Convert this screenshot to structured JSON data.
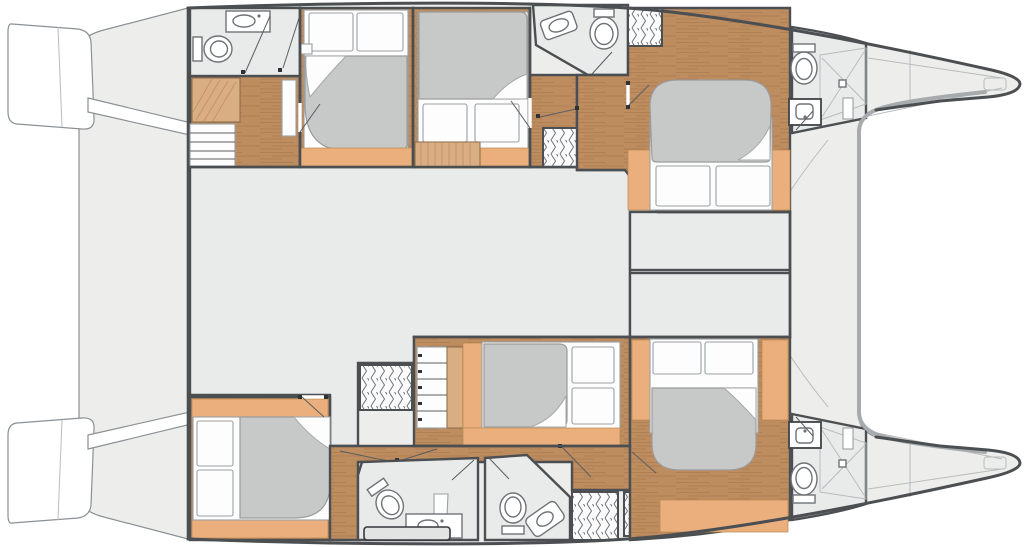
{
  "meta": {
    "type": "floor-plan",
    "subject": "catamaran-yacht-accommodation-deck",
    "orientation": "bow-right",
    "visible_text": "none"
  },
  "colors": {
    "wall": "#4b4f52",
    "deck": "#ededec",
    "floorGray": "#e9ebea",
    "wood": "#bd8c5f",
    "woodStreak": "#a1744a",
    "lighttan": "#eaaf7d",
    "stairwood": "#d9ae82",
    "mattress": "#c7c8c8",
    "sheet": "#fdfdfd",
    "fixture": "#6f7377",
    "hatch": "#70747a",
    "band": "#a7abad",
    "thin": "#b9bcbe",
    "outline": "#8b9094",
    "bg": "#ffffff"
  },
  "rooms": [
    {
      "name": "aft-bathroom-port"
    },
    {
      "name": "dressing-stairs-port"
    },
    {
      "name": "guest-cabin-1"
    },
    {
      "name": "guest-cabin-2"
    },
    {
      "name": "mid-bathroom-port"
    },
    {
      "name": "forward-cabin-port"
    },
    {
      "name": "bow-bathroom-port"
    },
    {
      "name": "forepeak-port"
    },
    {
      "name": "saloon"
    },
    {
      "name": "forward-locker-1"
    },
    {
      "name": "forward-locker-2"
    },
    {
      "name": "aft-cabin-starboard"
    },
    {
      "name": "mid-cabin-starboard"
    },
    {
      "name": "bathroom-starboard-1"
    },
    {
      "name": "bathroom-starboard-2"
    },
    {
      "name": "forward-cabin-starboard"
    },
    {
      "name": "bow-bathroom-starboard"
    },
    {
      "name": "forepeak-starboard"
    },
    {
      "name": "aft-deck"
    },
    {
      "name": "stern-platform"
    }
  ],
  "fixtures": {
    "beds": 6,
    "toilets": 6,
    "sinks": 6,
    "showers": 2,
    "hanging-lockers": 5,
    "stairs": 3
  }
}
